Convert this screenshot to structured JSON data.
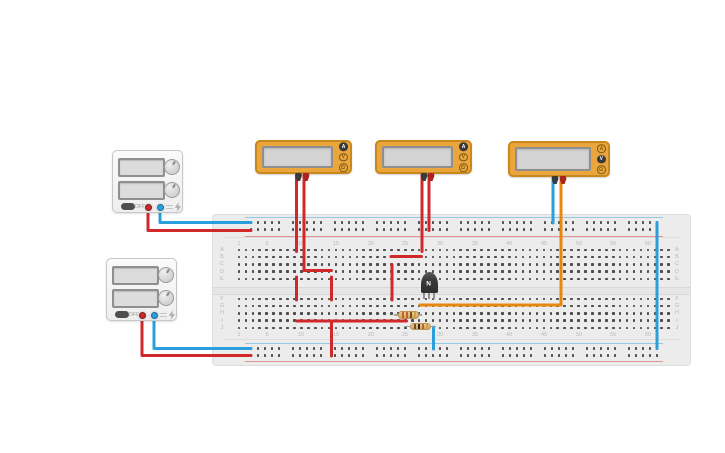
{
  "canvas": {
    "width": 725,
    "height": 453,
    "background": "#ffffff"
  },
  "breadboard": {
    "x": 213,
    "y": 215,
    "width": 477,
    "height": 150,
    "body_color": "#ececec",
    "hole_color": "#4d4d4d",
    "label_color": "#b8b8b8",
    "groove_color": "#d8d8d8",
    "negative_rail_color": "#2b9fdc",
    "positive_rail_color": "#d12929",
    "row_letters_top": [
      "A",
      "B",
      "C",
      "D",
      "E"
    ],
    "row_letters_bottom": [
      "F",
      "G",
      "H",
      "I",
      "J"
    ],
    "column_labels": [
      1,
      5,
      10,
      15,
      20,
      25,
      30,
      35,
      40,
      45,
      50,
      55,
      60
    ],
    "columns": 63
  },
  "power_supplies": [
    {
      "name": "power-supply-1",
      "x": 112,
      "y": 150,
      "width": 71,
      "height": 63,
      "off_label": "OFF"
    },
    {
      "name": "power-supply-2",
      "x": 106,
      "y": 258,
      "width": 71,
      "height": 63,
      "off_label": "OFF"
    }
  ],
  "multimeters": [
    {
      "name": "multimeter-1",
      "x": 255,
      "y": 140,
      "width": 97,
      "height": 34,
      "buttons": [
        "A",
        "V",
        "Ω"
      ],
      "mode": "A",
      "probe_centers": [
        41.5,
        49
      ]
    },
    {
      "name": "multimeter-2",
      "x": 375,
      "y": 140,
      "width": 97,
      "height": 34,
      "buttons": [
        "A",
        "V",
        "Ω"
      ],
      "mode": "A",
      "probe_centers": [
        47,
        54
      ]
    },
    {
      "name": "multimeter-3",
      "x": 508,
      "y": 141,
      "width": 102,
      "height": 36,
      "buttons": [
        "A",
        "V",
        "Ω"
      ],
      "mode": "V",
      "probe_centers": [
        45,
        53
      ]
    }
  ],
  "transistor": {
    "name": "transistor-npn",
    "label": "N",
    "x": 420.5,
    "y": 272,
    "width": 17,
    "height": 21,
    "legs_x": [
      424,
      429,
      434
    ],
    "legs_bottom": 299
  },
  "resistors": [
    {
      "name": "resistor-1",
      "y": 315,
      "x1": 394,
      "x2": 422,
      "band_colors": [
        "#c2651f",
        "#c2651f",
        "#7a4a21",
        "#cda43e"
      ]
    },
    {
      "name": "resistor-2",
      "y": 326.5,
      "x1": 404,
      "x2": 436,
      "band_colors": [
        "#7a4a21",
        "#252525",
        "#c2651f",
        "#cda43e"
      ]
    }
  ],
  "wire_palette": {
    "red": "#d12929",
    "blue": "#2b9fdc",
    "orange": "#e8860d"
  },
  "wires": [
    {
      "name": "ps1-positive-wire",
      "color": "#d12929",
      "points": [
        [
          148,
          210
        ],
        [
          148,
          230.5
        ],
        [
          251,
          230.5
        ]
      ]
    },
    {
      "name": "ps1-negative-wire",
      "color": "#2b9fdc",
      "points": [
        [
          160,
          210
        ],
        [
          160,
          222.5
        ],
        [
          251,
          222.5
        ]
      ]
    },
    {
      "name": "ps2-positive-wire",
      "color": "#d12929",
      "points": [
        [
          142,
          317
        ],
        [
          142,
          355.5
        ],
        [
          251,
          355.5
        ]
      ]
    },
    {
      "name": "ps2-negative-wire",
      "color": "#2b9fdc",
      "points": [
        [
          154,
          317
        ],
        [
          154,
          348.5
        ],
        [
          251,
          348.5
        ]
      ]
    },
    {
      "name": "mm1-black-probe-wire",
      "color": "#d12929",
      "points": [
        [
          296.5,
          175
        ],
        [
          296.5,
          251.5
        ]
      ]
    },
    {
      "name": "mm1-red-probe-wire",
      "color": "#d12929",
      "points": [
        [
          304,
          175
        ],
        [
          304,
          270.5
        ],
        [
          331.5,
          270.5
        ]
      ]
    },
    {
      "name": "jumper-row-e-f-left",
      "color": "#d12929",
      "points": [
        [
          296.5,
          277
        ],
        [
          296.5,
          300
        ]
      ]
    },
    {
      "name": "jumper-row-e-f-right",
      "color": "#d12929",
      "points": [
        [
          331.5,
          277
        ],
        [
          331.5,
          300
        ]
      ]
    },
    {
      "name": "mm2-black-probe-wire",
      "color": "#d12929",
      "points": [
        [
          422,
          175
        ],
        [
          422,
          251.5
        ]
      ]
    },
    {
      "name": "mm2-red-probe-wire",
      "color": "#d12929",
      "points": [
        [
          429,
          175
        ],
        [
          429,
          230.5
        ]
      ]
    },
    {
      "name": "jumper-row-b",
      "color": "#d12929",
      "points": [
        [
          391,
          256.5
        ],
        [
          421.5,
          256.5
        ]
      ]
    },
    {
      "name": "jumper-row-c-to-f",
      "color": "#d12929",
      "points": [
        [
          392,
          264.5
        ],
        [
          392,
          300
        ]
      ]
    },
    {
      "name": "row-i-bus-wire",
      "color": "#d12929",
      "points": [
        [
          296.5,
          321
        ],
        [
          406.5,
          321
        ]
      ]
    },
    {
      "name": "row-i-to-positive-rail",
      "color": "#d12929",
      "points": [
        [
          331.5,
          321
        ],
        [
          331.5,
          356
        ]
      ]
    },
    {
      "name": "mm3-black-probe-wire",
      "color": "#2b9fdc",
      "points": [
        [
          553,
          175
        ],
        [
          553,
          223
        ]
      ]
    },
    {
      "name": "mm3-red-probe-wire",
      "color": "#e8860d",
      "points": [
        [
          561,
          175
        ],
        [
          561,
          305
        ],
        [
          420,
          305
        ]
      ]
    },
    {
      "name": "resistor2-to-negative-rail",
      "color": "#2b9fdc",
      "points": [
        [
          433.5,
          327
        ],
        [
          433.5,
          349
        ]
      ]
    },
    {
      "name": "rails-bridge-wire",
      "color": "#2b9fdc",
      "points": [
        [
          657,
          222.5
        ],
        [
          657,
          348.5
        ]
      ]
    }
  ]
}
